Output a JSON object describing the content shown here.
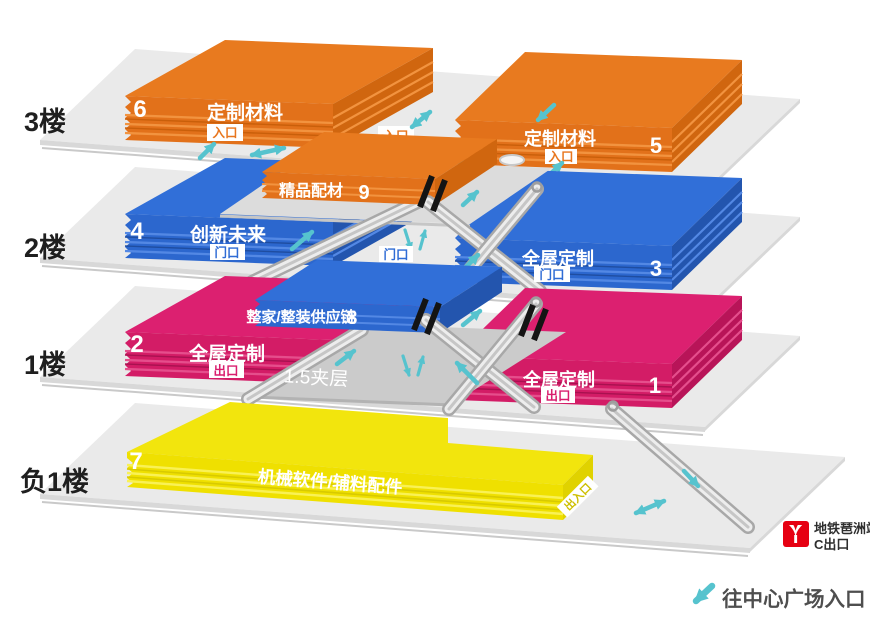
{
  "colors": {
    "orange": "#E8761E",
    "blue": "#2F6CD5",
    "magenta": "#D91E6E",
    "yellow": "#F0E20C",
    "teal": "#56C3CE",
    "slab_gray": "#EAEAEA",
    "metro_red": "#E60012"
  },
  "floors": [
    {
      "label": "3楼",
      "left_hall": {
        "number": "6",
        "name": "定制材料",
        "door": "入口"
      },
      "mid_door": "入口",
      "right_hall": {
        "number": "5",
        "name": "定制材料",
        "door": "入口"
      }
    },
    {
      "label": "2楼",
      "left_hall": {
        "number": "4",
        "name": "创新未来",
        "door": "门口"
      },
      "mid_hall": {
        "number": "9",
        "name": "精品配材"
      },
      "mid_door": "门口",
      "right_hall": {
        "number": "3",
        "name": "全屋定制",
        "door": "门口"
      }
    },
    {
      "label": "1楼",
      "left_hall": {
        "number": "2",
        "name": "全屋定制",
        "door": "出口"
      },
      "mid_hall": {
        "number": "8",
        "name": "整家/整装供应链"
      },
      "mezzanine": "1.5夹层",
      "right_hall": {
        "number": "1",
        "name": "全屋定制",
        "door": "出口"
      }
    },
    {
      "label": "负1楼",
      "left_hall": {
        "number": "7",
        "name": "机械软件/辅料配件",
        "door": "出入口"
      }
    }
  ],
  "metro": {
    "station": "地铁琶洲站",
    "exit": "C出口"
  },
  "plaza": {
    "note": "往中心广场入口"
  },
  "icons": [
    "arrow-up-right-icon",
    "arrow-double-icon",
    "arrow-down-left-icon",
    "arrow-down-right-icon",
    "arrow-up-down-icon",
    "metro-logo-icon",
    "escalator-ramp",
    "stair-shaft"
  ]
}
